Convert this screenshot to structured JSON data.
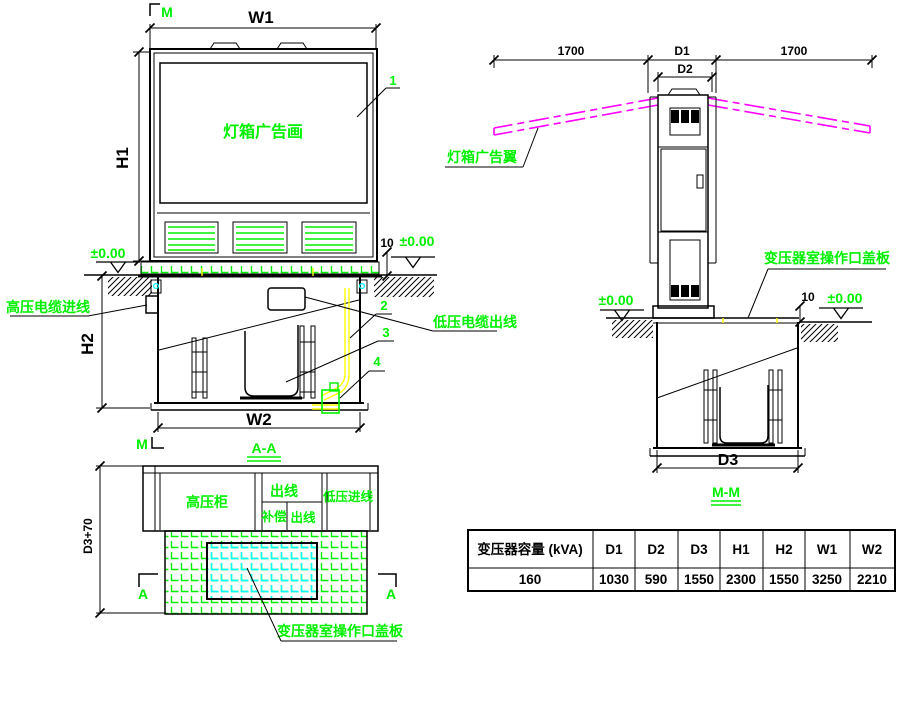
{
  "front_view": {
    "section_marker_top": "M",
    "section_marker_bottom": "M",
    "dim_w1": "W1",
    "dim_h1": "H1",
    "dim_h2": "H2",
    "dim_w2": "W2",
    "dim_10": "10",
    "level": "±0.00",
    "lightbox_text": "灯箱广告画",
    "callout_1": "1",
    "callout_2": "2",
    "callout_3": "3",
    "callout_4": "4",
    "hv_cable_in": "高压电缆进线",
    "lv_cable_out": "低压电缆出线",
    "title": "A-A"
  },
  "side_view": {
    "dim_1700": "1700",
    "dim_d1": "D1",
    "dim_d2": "D2",
    "dim_d3": "D3",
    "dim_10": "10",
    "level": "±0.00",
    "wing_label": "灯箱广告翼",
    "cover_label": "变压器室操作口盖板",
    "title": "M-M"
  },
  "plan_view": {
    "dim_d3_70": "D3+70",
    "hv_cabinet": "高压柜",
    "outgoing_1": "出线",
    "compensation": "补偿",
    "outgoing_2": "出线",
    "lv_incoming": "低压进线",
    "section_marker": "A",
    "cover_label": "变压器室操作口盖板"
  },
  "table": {
    "headers": [
      "变压器容量 (kVA)",
      "D1",
      "D2",
      "D3",
      "H1",
      "H2",
      "W1",
      "W2"
    ],
    "values": [
      "160",
      "1030",
      "590",
      "1550",
      "2300",
      "1550",
      "3250",
      "2210"
    ]
  },
  "colors": {
    "annotation_green": "#00f000",
    "wing_magenta": "#ff00ff",
    "cable_yellow": "#ffff00",
    "cover_cyan": "#00ffff",
    "line_black": "#000000"
  }
}
